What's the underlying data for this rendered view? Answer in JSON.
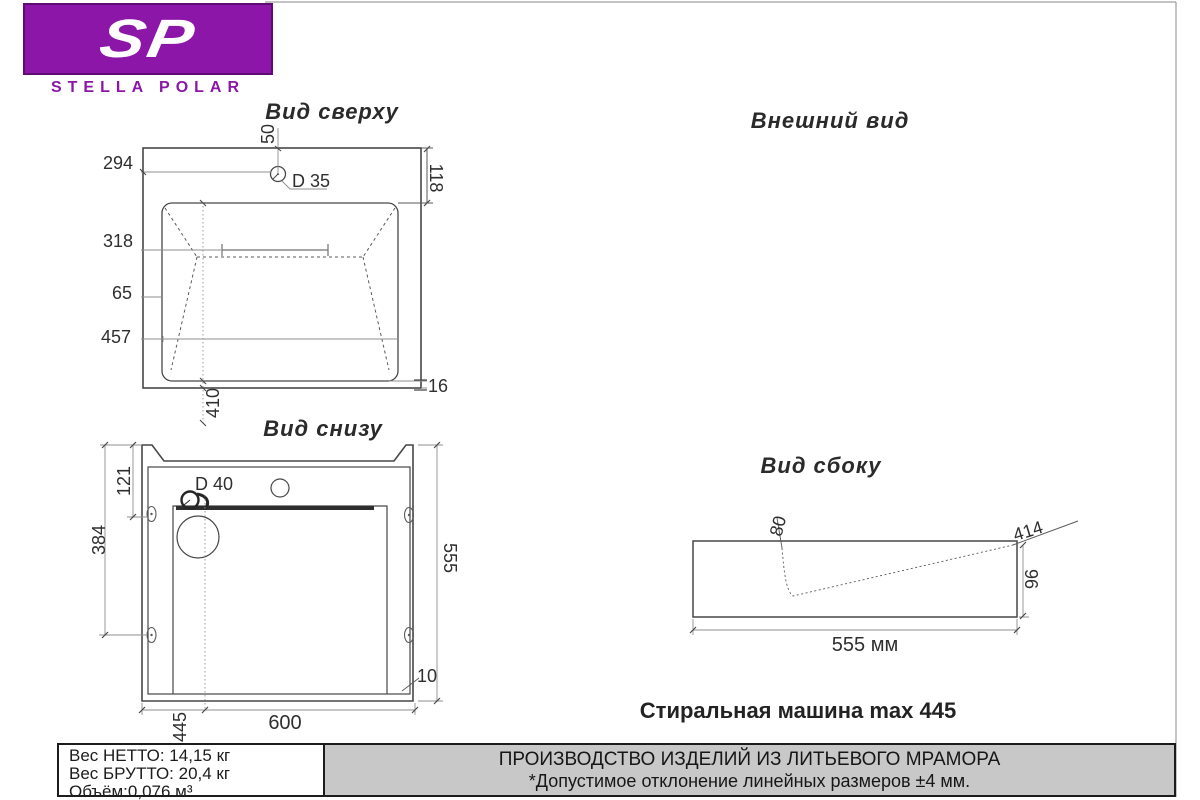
{
  "brand": {
    "monogram": "SP",
    "name": "STELLA POLAR"
  },
  "views": {
    "top": {
      "title": "Вид сверху",
      "hole_label": "D 35",
      "d50": "50",
      "d294": "294",
      "d318": "318",
      "d65": "65",
      "d457": "457",
      "d410": "410",
      "d118": "118",
      "d16": "16"
    },
    "bottom": {
      "title": "Вид снизу",
      "drain_label": "D 40",
      "d121": "121",
      "d384": "384",
      "d555": "555",
      "d10": "10",
      "d600": "600",
      "d445": "445"
    },
    "external": {
      "title": "Внешний вид"
    },
    "side": {
      "title": "Вид сбоку",
      "d80": "80",
      "d414": "414",
      "d96": "96",
      "d555mm": "555 мм"
    }
  },
  "caption": "Стиральная машина max 445",
  "footer": {
    "weight_net": "Вес НЕТТО: 14,15 кг",
    "weight_gross": "Вес БРУТТО: 20,4 кг",
    "volume": "Объём:0,076 м³",
    "production": "ПРОИЗВОДСТВО ИЗДЕЛИЙ ИЗ ЛИТЬЕВОГО МРАМОРА",
    "tolerance": "*Допустимое отклонение линейных размеров ±4 мм."
  },
  "colors": {
    "brand_purple": "#8c16a8",
    "footer_gray": "#c8c8c8",
    "line_dark": "#474747"
  }
}
